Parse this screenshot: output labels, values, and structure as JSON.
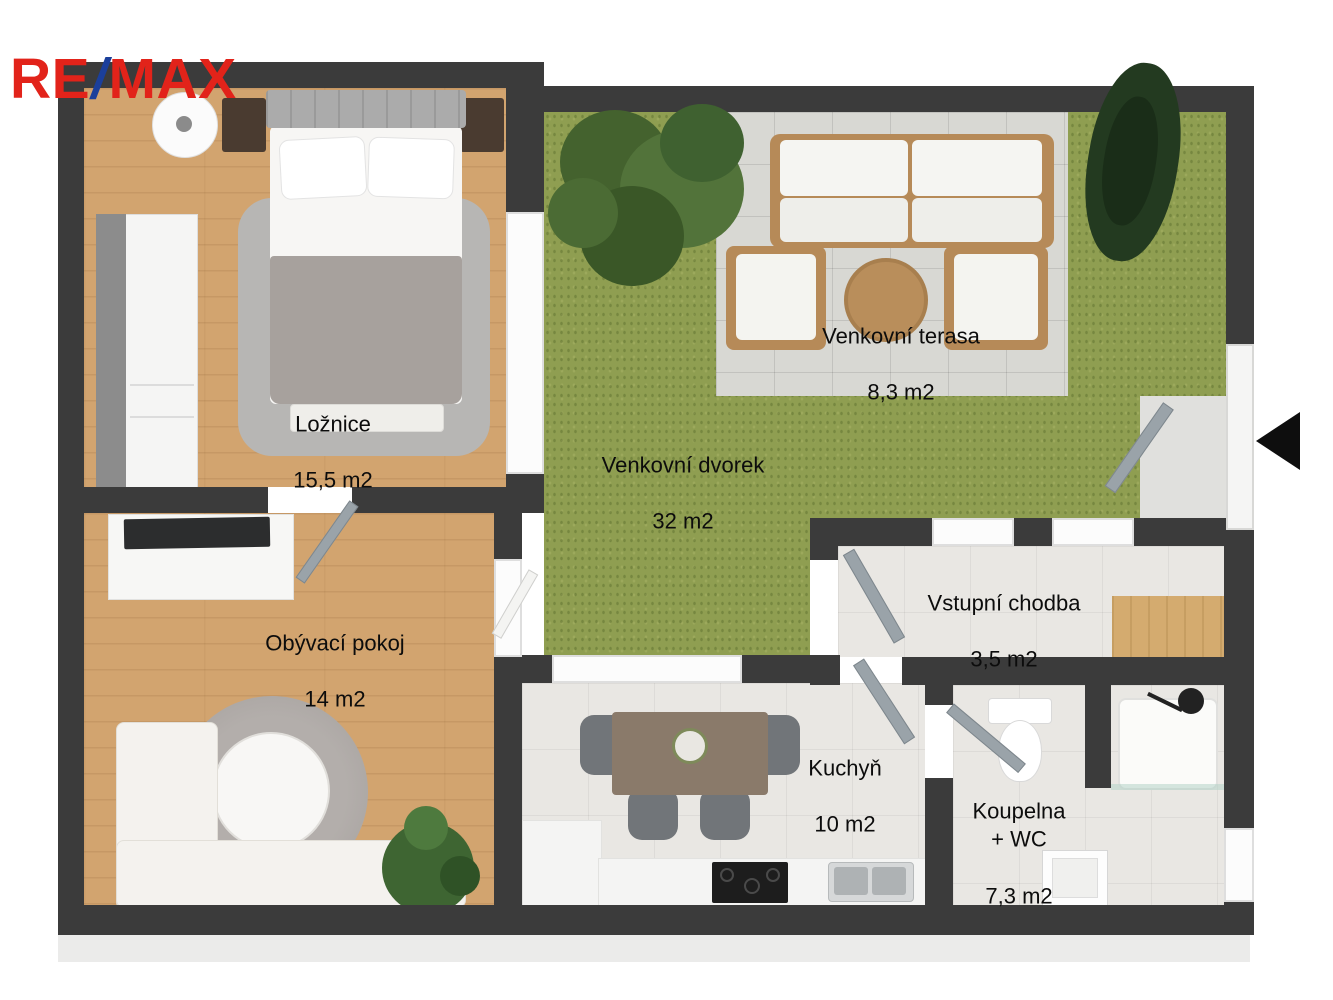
{
  "brand": {
    "re": "RE",
    "slash": "/",
    "max": "MAX",
    "red": "#e2231a",
    "blue": "#1b3f9b"
  },
  "entrance": {
    "arrow_icon": "left-triangle-arrow",
    "color": "#0e0e0e"
  },
  "rooms": [
    {
      "id": "loznice",
      "label": "Ložnice",
      "area": "15,5 m2"
    },
    {
      "id": "obyvaci-pokoj",
      "label": "Obývací pokoj",
      "area": "14 m2"
    },
    {
      "id": "venkovni-dvorek",
      "label": "Venkovní dvorek",
      "area": "32 m2"
    },
    {
      "id": "venkovni-terasa",
      "label": "Venkovní terasa",
      "area": "8,3 m2"
    },
    {
      "id": "vstupni-chodba",
      "label": "Vstupní chodba",
      "area": "3,5 m2"
    },
    {
      "id": "kuchyn",
      "label": "Kuchyň",
      "area": "10 m2"
    },
    {
      "id": "koupelna-wc",
      "label": "Koupelna\n+ WC",
      "area": "7,3 m2"
    }
  ],
  "palette": {
    "wall": "#3b3b3b",
    "wood_floor": "#d2a46f",
    "grass": "#8f9e51",
    "terrace_tile": "#d8d8d3",
    "interior_tile": "#e9e7e3",
    "door": "#9aa3a9"
  }
}
